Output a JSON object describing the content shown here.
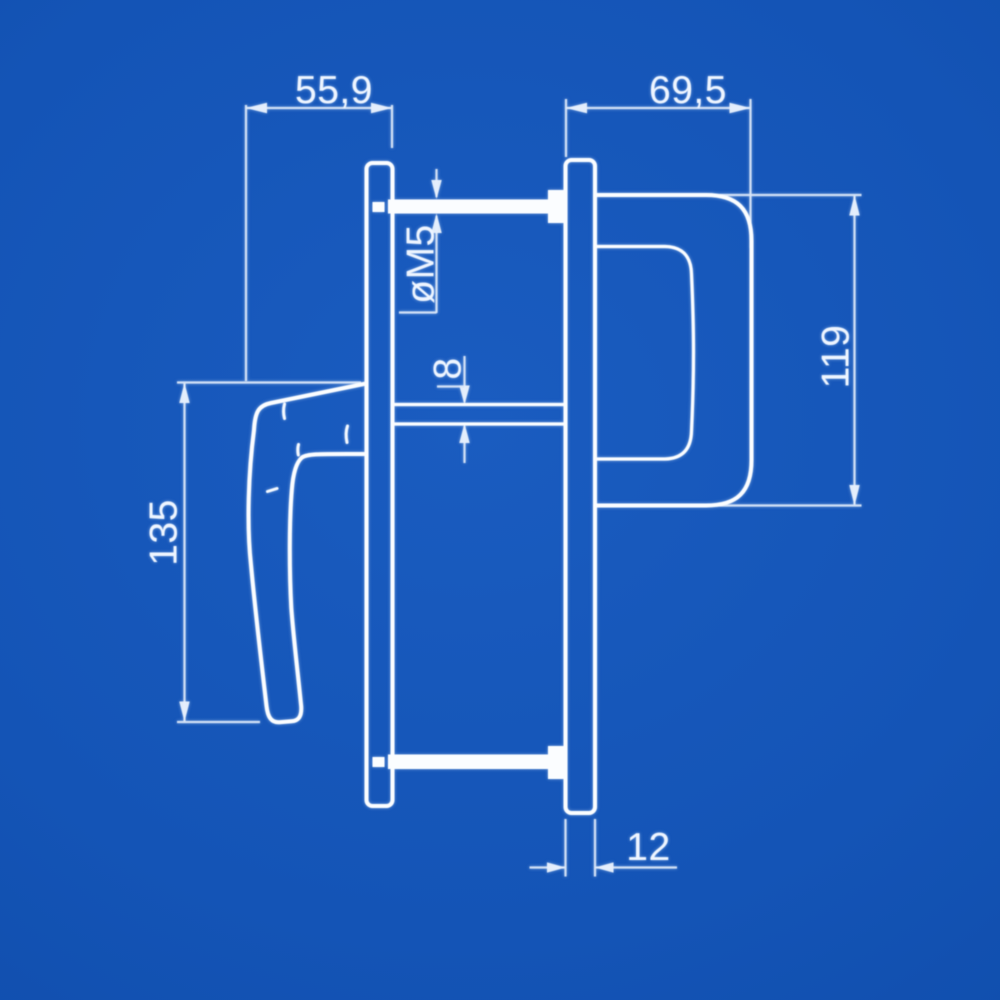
{
  "colors": {
    "background_center": "#1a5cc0",
    "background_edge": "#0b45a0",
    "object_line": "#fbfdff",
    "dimension_line": "#d9e6f8"
  },
  "dimensions": {
    "handle_offset_width": "55,9",
    "grip_depth": "69,5",
    "screw_thread": "øM5",
    "spindle_square": "8",
    "lever_length": "135",
    "grip_height": "119",
    "plate_thickness": "12"
  }
}
